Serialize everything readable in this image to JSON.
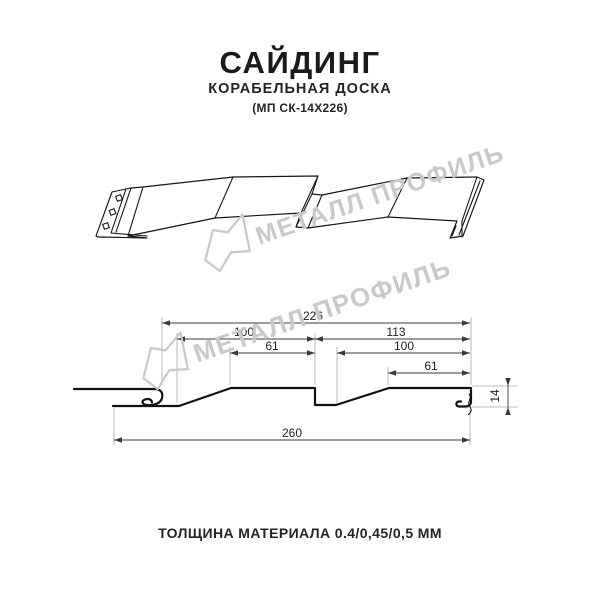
{
  "header": {
    "title": "САЙДИНГ",
    "subtitle": "КОРАБЕЛЬНАЯ ДОСКА",
    "product_code": "(МП СК-14Х226)"
  },
  "footer": {
    "thickness_note": "ТОЛЩИНА МАТЕРИАЛА 0.4/0,45/0,5 ММ"
  },
  "watermark": {
    "brand": "МЕТАЛЛ ПРОФИЛЬ",
    "color": "#c9c9c9"
  },
  "drawing": {
    "type": "technical-profile-diagram",
    "views": [
      "3d-perspective-view",
      "dimensioned-cross-section"
    ],
    "dimensions_mm": {
      "coverage_width": "226",
      "left_wave_width": "100",
      "left_wave_flat": "61",
      "right_wave_span": "113",
      "right_wave_width": "100",
      "right_wave_flat": "61",
      "overall_width": "260",
      "profile_height": "14"
    }
  },
  "colors": {
    "background": "#ffffff",
    "line": "#161616",
    "dimension_line": "#3a3a3a",
    "extension_line": "#a6a6a6",
    "watermark": "#c9c9c9",
    "text": "#1f1f1f"
  }
}
